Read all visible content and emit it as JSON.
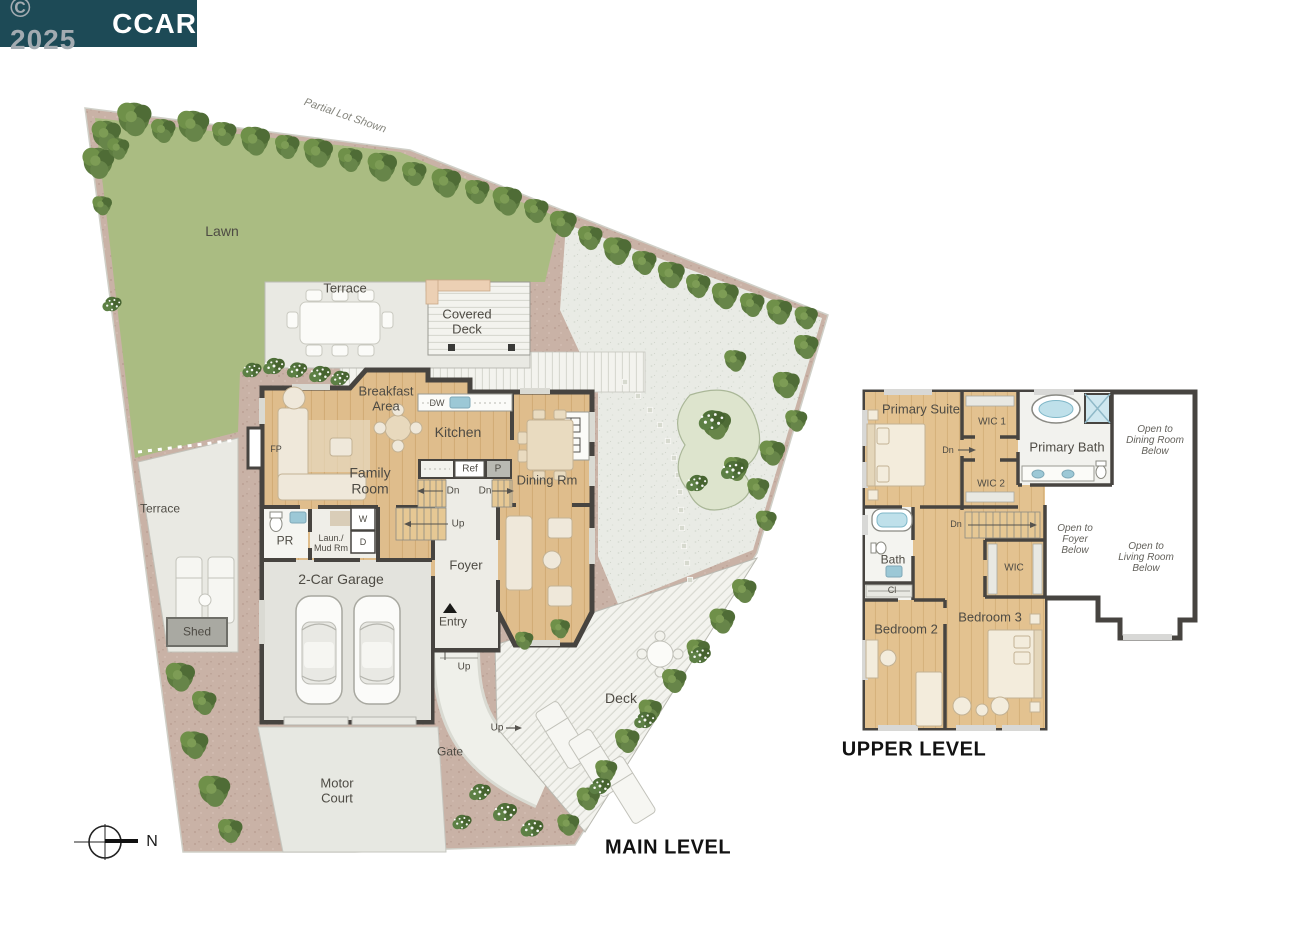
{
  "watermark": {
    "year_part": "© 2025",
    "brand": "CCAR",
    "bg_color": "#1d4a56",
    "brand_color": "#ffffff",
    "year_color": "#a3abb1"
  },
  "main_level": {
    "title": "MAIN LEVEL",
    "compass_n": "N",
    "labels": {
      "partial_lot": "Partial Lot Shown",
      "lawn": "Lawn",
      "terrace_top": "Terrace",
      "covered_deck": "Covered\nDeck",
      "breakfast_area": "Breakfast\nArea",
      "kitchen": "Kitchen",
      "dw": "DW",
      "ref": "Ref",
      "pantry": "P",
      "dining_rm": "Dining Rm",
      "family_room": "Family\nRoom",
      "fp": "FP",
      "pr": "PR",
      "laundry_mud": "Laun./\nMud Rm",
      "washer": "W",
      "dryer": "D",
      "dn_left": "Dn",
      "dn_right": "Dn",
      "up_stairs": "Up",
      "foyer": "Foyer",
      "entry": "Entry",
      "garage": "2-Car Garage",
      "up_entry": "Up",
      "up_deck": "Up",
      "gate": "Gate",
      "motor_court": "Motor\nCourt",
      "shed": "Shed",
      "terrace_left": "Terrace",
      "deck": "Deck"
    }
  },
  "upper_level": {
    "title": "UPPER LEVEL",
    "labels": {
      "primary_suite": "Primary Suite",
      "wic1": "WIC 1",
      "dn_hall": "Dn",
      "primary_bath": "Primary Bath",
      "wic2": "WIC 2",
      "open_dining": "Open to\nDining Room\nBelow",
      "dn_stairs": "Dn",
      "open_foyer": "Open to\nFoyer\nBelow",
      "open_living": "Open to\nLiving Room\nBelow",
      "bath": "Bath",
      "closet": "Cl",
      "wic3": "WIC",
      "bedroom2": "Bedroom 2",
      "bedroom3": "Bedroom 3"
    }
  },
  "palette": {
    "walls": "#474440",
    "wood": "#dfbd8c",
    "lawn": "#aabc82",
    "gravel": "#e9ebe5",
    "dirt": "#c9b2a6",
    "deck": "#f3f3ee",
    "fixture_water": "#9cc8d6"
  }
}
